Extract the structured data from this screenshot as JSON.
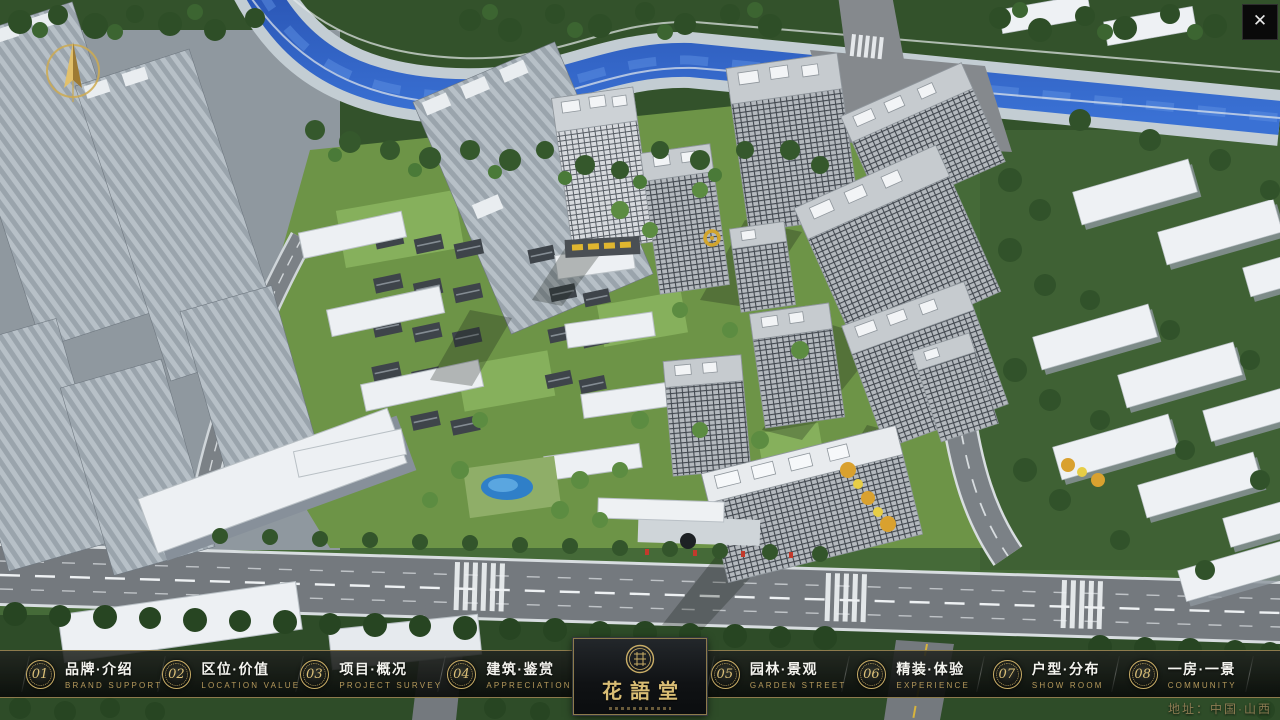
{
  "header": {
    "close_label": "✕"
  },
  "navbar": {
    "logo": {
      "title": "花語堂"
    },
    "items": [
      {
        "num": "01",
        "zh": "品牌·介绍",
        "en": "BRAND SUPPORT"
      },
      {
        "num": "02",
        "zh": "区位·价值",
        "en": "LOCATION VALUE"
      },
      {
        "num": "03",
        "zh": "项目·概况",
        "en": "PROJECT SURVEY"
      },
      {
        "num": "04",
        "zh": "建筑·鉴赏",
        "en": "APPRECIATION"
      },
      {
        "num": "05",
        "zh": "园林·景观",
        "en": "GARDEN STREET"
      },
      {
        "num": "06",
        "zh": "精装·体验",
        "en": "EXPERIENCE"
      },
      {
        "num": "07",
        "zh": "户型·分布",
        "en": "SHOW ROOM"
      },
      {
        "num": "08",
        "zh": "一房·一景",
        "en": "COMMUNITY"
      }
    ]
  },
  "footer": {
    "address": "地址：中国·山西"
  },
  "colors": {
    "gold": "#c9ad66",
    "gold_dim": "#8d7b4c",
    "bar_background": "rgba(10,12,10,0.9)",
    "river": "#2a5fc4"
  }
}
